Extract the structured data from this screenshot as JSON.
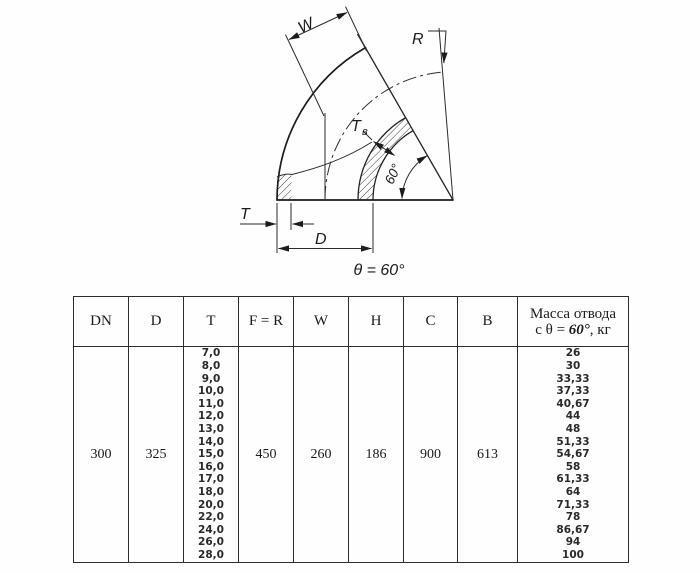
{
  "drawing": {
    "labels": {
      "w": "W",
      "r": "R",
      "tb_main": "Т",
      "tb_sub": "в",
      "angle": "60°",
      "t": "T",
      "d": "D"
    },
    "caption": "θ = 60°"
  },
  "table": {
    "headers": [
      "DN",
      "D",
      "T",
      "F = R",
      "W",
      "H",
      "C",
      "B"
    ],
    "mass_header": {
      "line1": "Масса отвода",
      "line2_pre": "с θ = ",
      "line2_deg": "60°",
      "line2_post": ", кг"
    },
    "row": {
      "dn": "300",
      "d": "325",
      "t_values": [
        "7,0",
        "8,0",
        "9,0",
        "10,0",
        "11,0",
        "12,0",
        "13,0",
        "14,0",
        "15,0",
        "16,0",
        "17,0",
        "18,0",
        "20,0",
        "22,0",
        "24,0",
        "26,0",
        "28,0"
      ],
      "fr": "450",
      "w": "260",
      "h": "186",
      "c": "900",
      "b": "613",
      "mass_values": [
        "26",
        "30",
        "33,33",
        "37,33",
        "40,67",
        "44",
        "48",
        "51,33",
        "54,67",
        "58",
        "61,33",
        "64",
        "71,33",
        "78",
        "86,67",
        "94",
        "100"
      ]
    }
  }
}
